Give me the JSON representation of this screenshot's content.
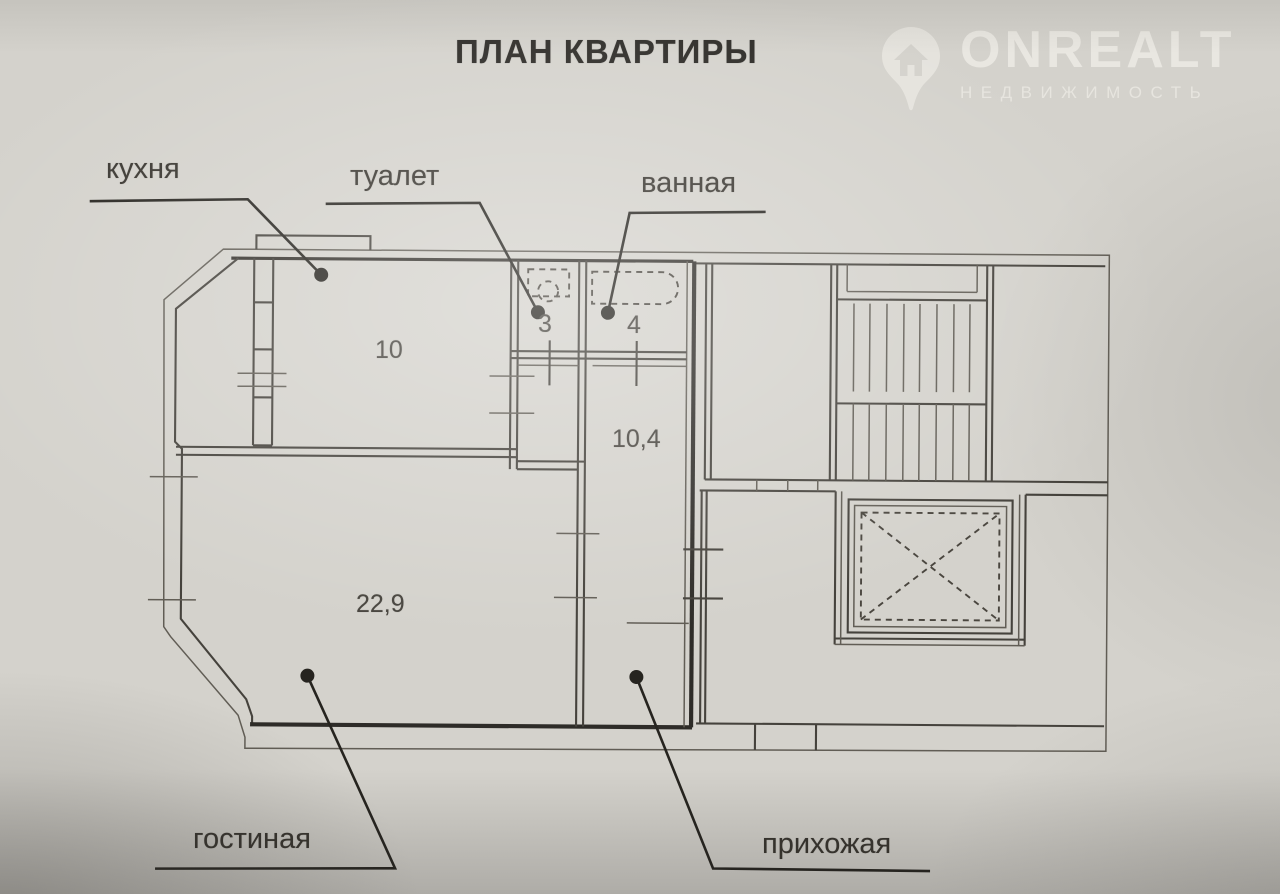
{
  "title": "ПЛАН КВАРТИРЫ",
  "watermark": {
    "brand": "ONREALT",
    "subtitle": "НЕДВИЖИМОСТЬ",
    "icon": "location-pin-house-icon"
  },
  "rooms": [
    {
      "key": "kitchen",
      "label": "кухня",
      "area": "10"
    },
    {
      "key": "toilet",
      "label": "туалет",
      "area": "3"
    },
    {
      "key": "bathroom",
      "label": "ванная",
      "area": "4"
    },
    {
      "key": "hallway",
      "label": "прихожая",
      "area": "10,4"
    },
    {
      "key": "living",
      "label": "гостиная",
      "area": "22,9"
    }
  ],
  "colors": {
    "paper": "#d4d2cc",
    "ink": "#45423c",
    "thick_wall": "#2e2c28",
    "watermark": "rgba(250,248,242,0.55)"
  }
}
